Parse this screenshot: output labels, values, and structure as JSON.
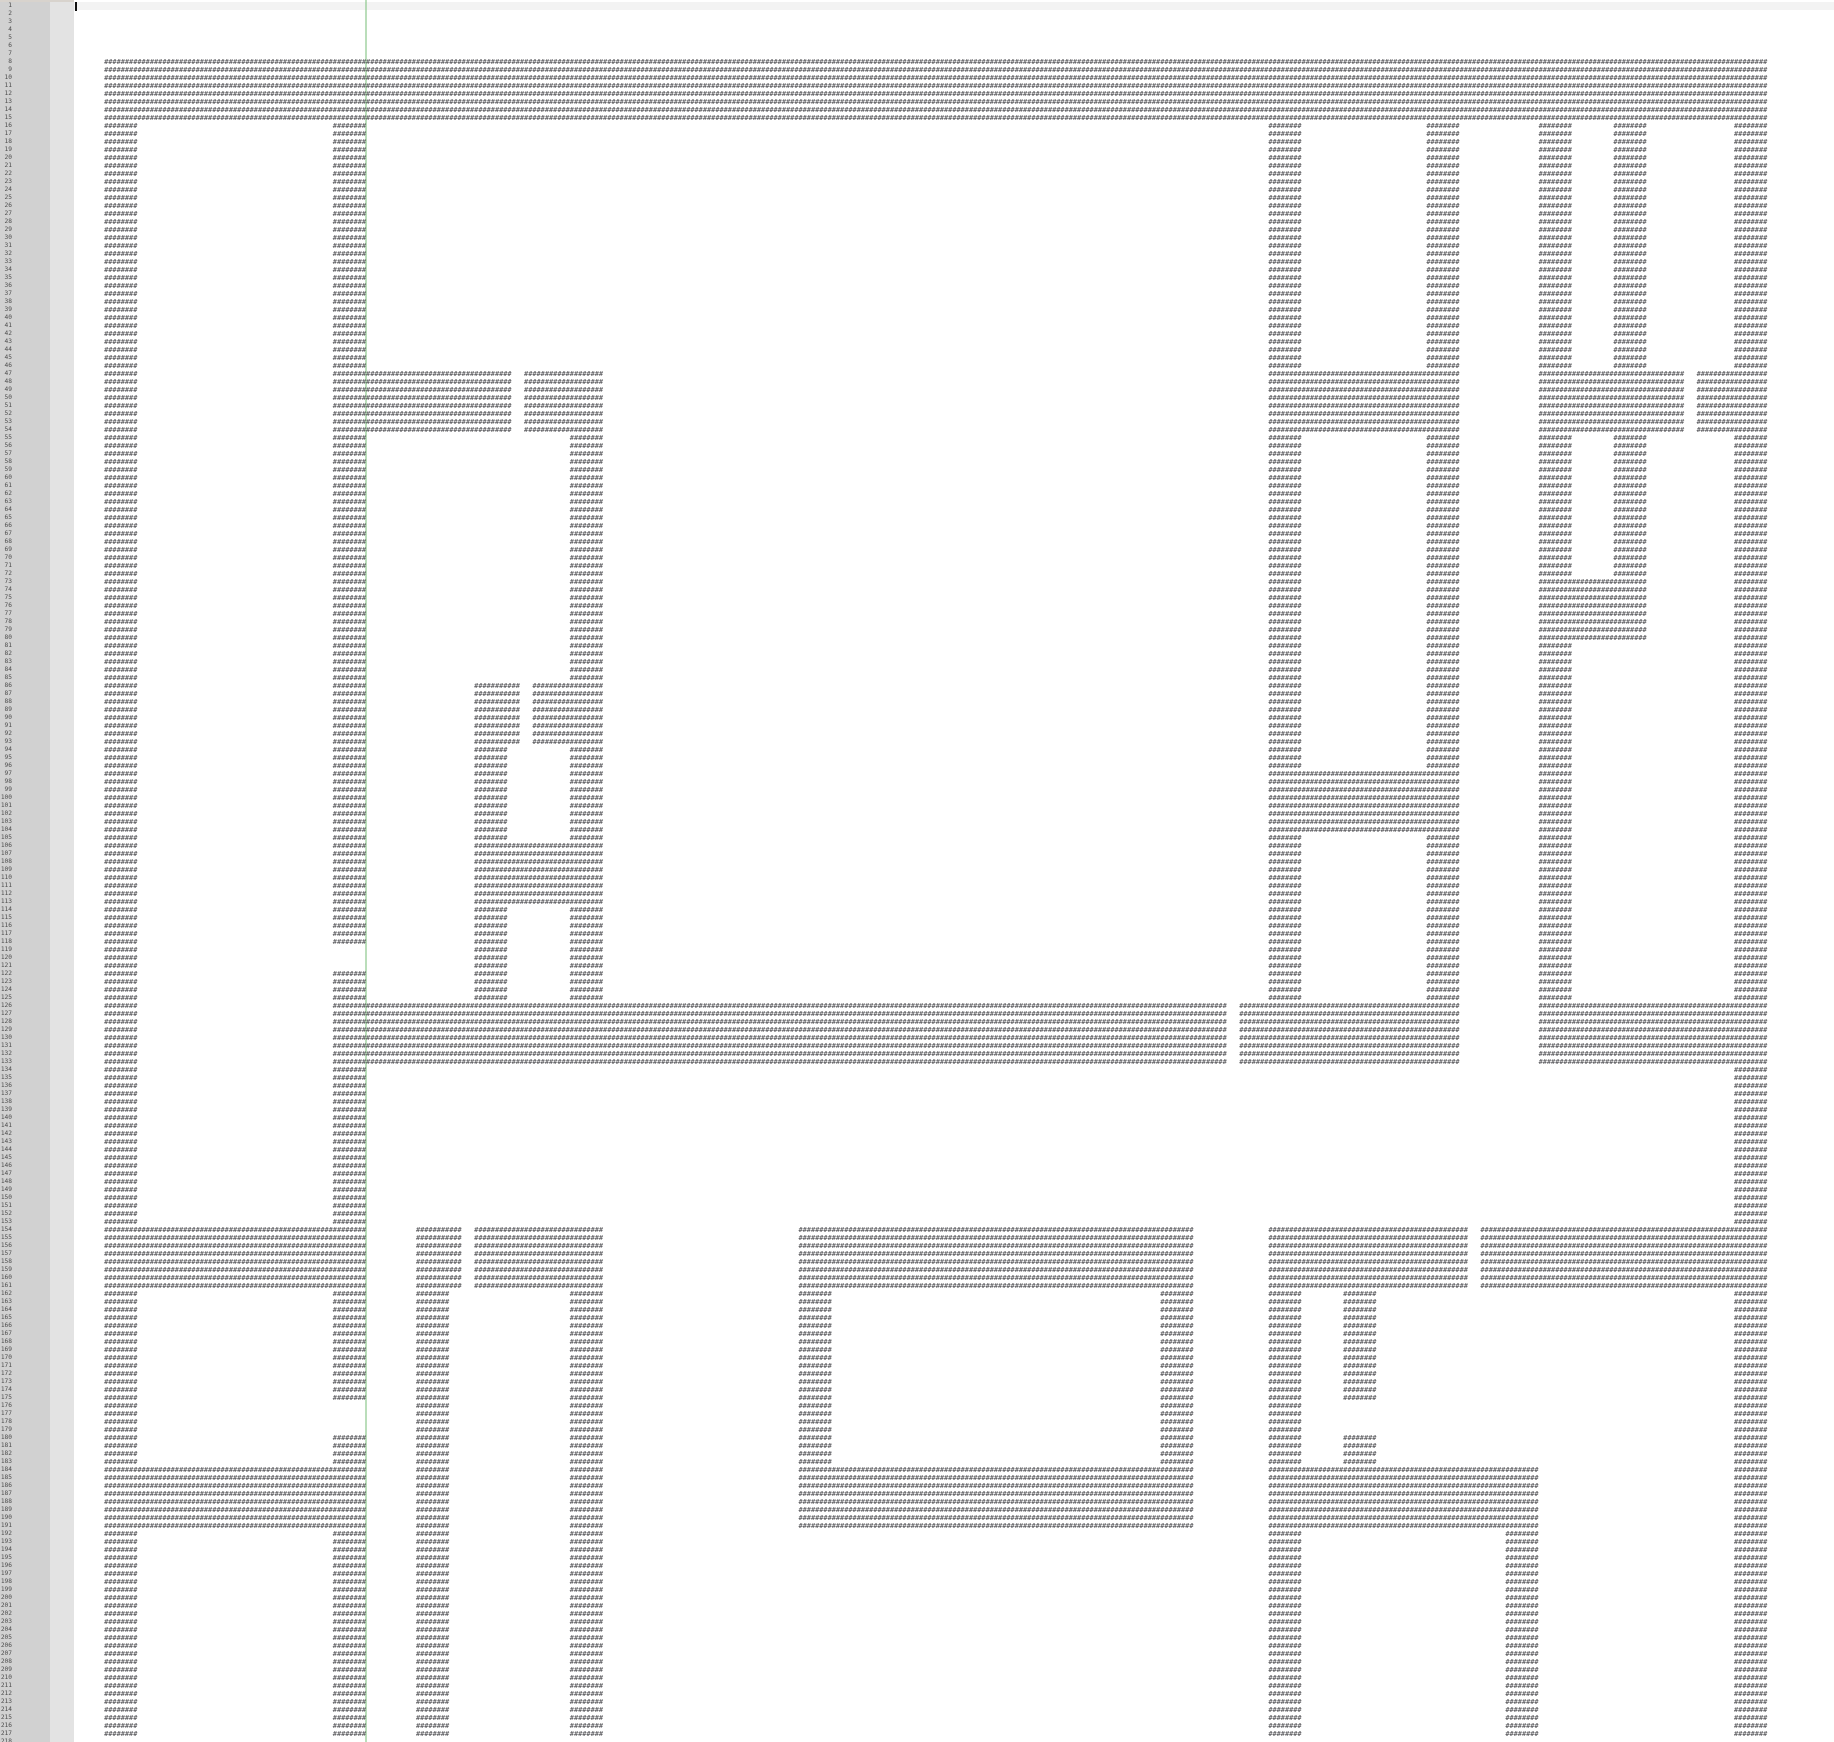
{
  "editor": {
    "type": "text-editor-viewport",
    "content_kind": "ascii-maze",
    "wall_char": "#",
    "total_lines": 218,
    "line_width_chars": 407,
    "first_visible_line": 1,
    "cursor": {
      "line": 1,
      "column": 1
    },
    "current_line": 1,
    "ruler_column": 70
  },
  "gutter": {
    "line_numbers_from": 1,
    "line_numbers_to": 218
  },
  "colors": {
    "top-strip": "#d8d3cd",
    "gutter-bg": "#d1d1d1",
    "gutter-inner-bg": "#e3e3e3",
    "num-color": "#4c4c4c",
    "text-color": "#4b4b4f",
    "line-highlight": "#f3f3f3",
    "ruler-color": "rgba(140,200,140,0.6)",
    "cursor-color": "#101010",
    "editor-bg": "#ffffff"
  },
  "maze": {
    "rect_format": "[line_start, line_end, col_start, col_end] lines 1-based inclusive, cols 0-based inclusive",
    "rects": [
      [
        8,
        15,
        7,
        406
      ],
      [
        16,
        217,
        7,
        14
      ],
      [
        16,
        118,
        62,
        69
      ],
      [
        122,
        153,
        62,
        69
      ],
      [
        162,
        175,
        62,
        69
      ],
      [
        180,
        217,
        62,
        69
      ],
      [
        47,
        54,
        62,
        104
      ],
      [
        47,
        54,
        108,
        126
      ],
      [
        55,
        125,
        119,
        126
      ],
      [
        162,
        217,
        119,
        126
      ],
      [
        86,
        93,
        96,
        106
      ],
      [
        86,
        93,
        110,
        126
      ],
      [
        94,
        125,
        96,
        103
      ],
      [
        106,
        113,
        96,
        126
      ],
      [
        126,
        133,
        62,
        276
      ],
      [
        126,
        133,
        280,
        332
      ],
      [
        126,
        133,
        352,
        406
      ],
      [
        154,
        161,
        7,
        69
      ],
      [
        154,
        161,
        82,
        92
      ],
      [
        154,
        161,
        96,
        126
      ],
      [
        154,
        217,
        82,
        89
      ],
      [
        184,
        191,
        7,
        69
      ],
      [
        154,
        161,
        174,
        268
      ],
      [
        162,
        183,
        174,
        181
      ],
      [
        162,
        183,
        261,
        268
      ],
      [
        184,
        191,
        174,
        268
      ],
      [
        16,
        46,
        287,
        294
      ],
      [
        55,
        96,
        287,
        294
      ],
      [
        105,
        125,
        287,
        294
      ],
      [
        162,
        183,
        287,
        294
      ],
      [
        192,
        217,
        287,
        294
      ],
      [
        16,
        46,
        325,
        332
      ],
      [
        55,
        96,
        325,
        332
      ],
      [
        105,
        125,
        325,
        332
      ],
      [
        97,
        104,
        287,
        332
      ],
      [
        47,
        54,
        287,
        332
      ],
      [
        47,
        54,
        352,
        386
      ],
      [
        47,
        54,
        390,
        406
      ],
      [
        16,
        72,
        352,
        359
      ],
      [
        73,
        80,
        352,
        377
      ],
      [
        81,
        125,
        352,
        359
      ],
      [
        16,
        72,
        370,
        377
      ],
      [
        16,
        217,
        399,
        406
      ],
      [
        154,
        161,
        287,
        334
      ],
      [
        154,
        161,
        338,
        406
      ],
      [
        162,
        175,
        305,
        312
      ],
      [
        180,
        183,
        305,
        312
      ],
      [
        184,
        191,
        287,
        351
      ],
      [
        192,
        217,
        344,
        351
      ]
    ]
  }
}
